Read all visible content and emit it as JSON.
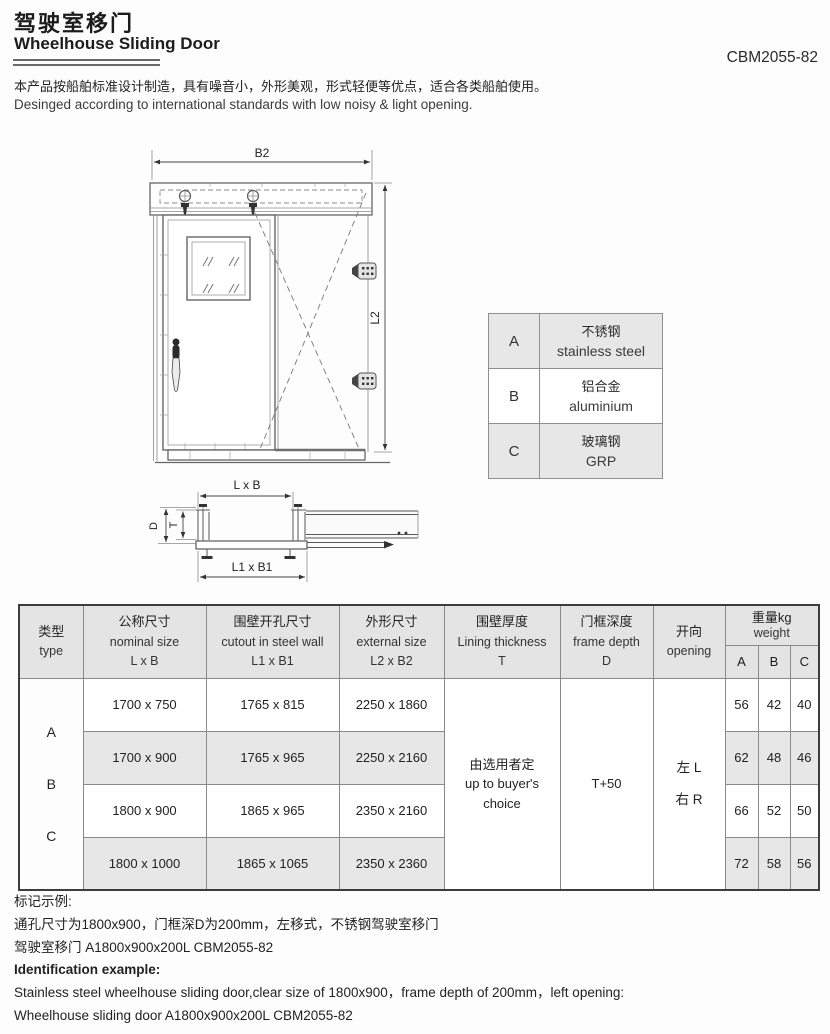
{
  "header": {
    "title_zh": "驾驶室移门",
    "title_en": "Wheelhouse Sliding Door",
    "model": "CBM2055-82",
    "desc_zh": "本产品按船舶标准设计制造，具有噪音小，外形美观，形式轻便等优点，适合各类船舶使用。",
    "desc_en": "Desinged according to international standards with low noisy & light opening."
  },
  "drawing": {
    "b2": "B2",
    "l2": "L2",
    "lxb": "L x B",
    "l1xb1": "L1 x B1",
    "d": "D",
    "t": "T"
  },
  "material_table": {
    "rows": [
      {
        "key": "A",
        "zh": "不锈钢",
        "en": "stainless steel"
      },
      {
        "key": "B",
        "zh": "铝合金",
        "en": "aluminium"
      },
      {
        "key": "C",
        "zh": "玻璃钢",
        "en": "GRP"
      }
    ]
  },
  "spec_table": {
    "headers": {
      "type": {
        "zh": "类型",
        "en": "type"
      },
      "nominal": {
        "zh": "公称尺寸",
        "en": "nominal size",
        "sub": "L x B"
      },
      "cutout": {
        "zh": "围壁开孔尺寸",
        "en": "cutout in steel wall",
        "sub": "L1 x B1"
      },
      "external": {
        "zh": "外形尺寸",
        "en": "external size",
        "sub": "L2 x B2"
      },
      "lining": {
        "zh": "围壁厚度",
        "en": "Lining thickness",
        "sub": "T"
      },
      "frame": {
        "zh": "门框深度",
        "en": "frame depth",
        "sub": "D"
      },
      "opening": {
        "zh": "开向",
        "en": "opening"
      },
      "weight": {
        "zh": "重量kg",
        "en": "weight"
      },
      "weight_cols": [
        "A",
        "B",
        "C"
      ]
    },
    "types": [
      "A",
      "B",
      "C"
    ],
    "rows": [
      {
        "nominal": "1700 x 750",
        "cutout": "1765 x 815",
        "external": "2250 x 1860",
        "wa": "56",
        "wb": "42",
        "wc": "40"
      },
      {
        "nominal": "1700 x 900",
        "cutout": "1765 x 965",
        "external": "2250 x 2160",
        "wa": "62",
        "wb": "48",
        "wc": "46"
      },
      {
        "nominal": "1800 x 900",
        "cutout": "1865 x 965",
        "external": "2350 x 2160",
        "wa": "66",
        "wb": "52",
        "wc": "50"
      },
      {
        "nominal": "1800 x 1000",
        "cutout": "1865 x 1065",
        "external": "2350 x 2360",
        "wa": "72",
        "wb": "58",
        "wc": "56"
      }
    ],
    "merged": {
      "lining_lines": [
        "由选用者定",
        "up to buyer's",
        "choice"
      ],
      "frame_depth": "T+50",
      "opening_left": "左 L",
      "opening_right": "右 R"
    }
  },
  "footer": {
    "example_zh_title": "标记示例:",
    "example_zh_line1": "通孔尺寸为1800x900，门框深D为200mm，左移式，不锈钢驾驶室移门",
    "example_zh_line2": "驾驶室移门 A1800x900x200L CBM2055-82",
    "example_en_title": "Identification example:",
    "example_en_line1": "Stainless steel wheelhouse sliding door,clear size of 1800x900，frame depth of 200mm，left opening:",
    "example_en_line2": "Wheelhouse sliding door A1800x900x200L CBM2055-82"
  },
  "colors": {
    "table_shade": "#e7e7e7",
    "header_shade": "#e4e4e4",
    "line_gray": "#555555",
    "text_dark": "#1c1c1c"
  }
}
